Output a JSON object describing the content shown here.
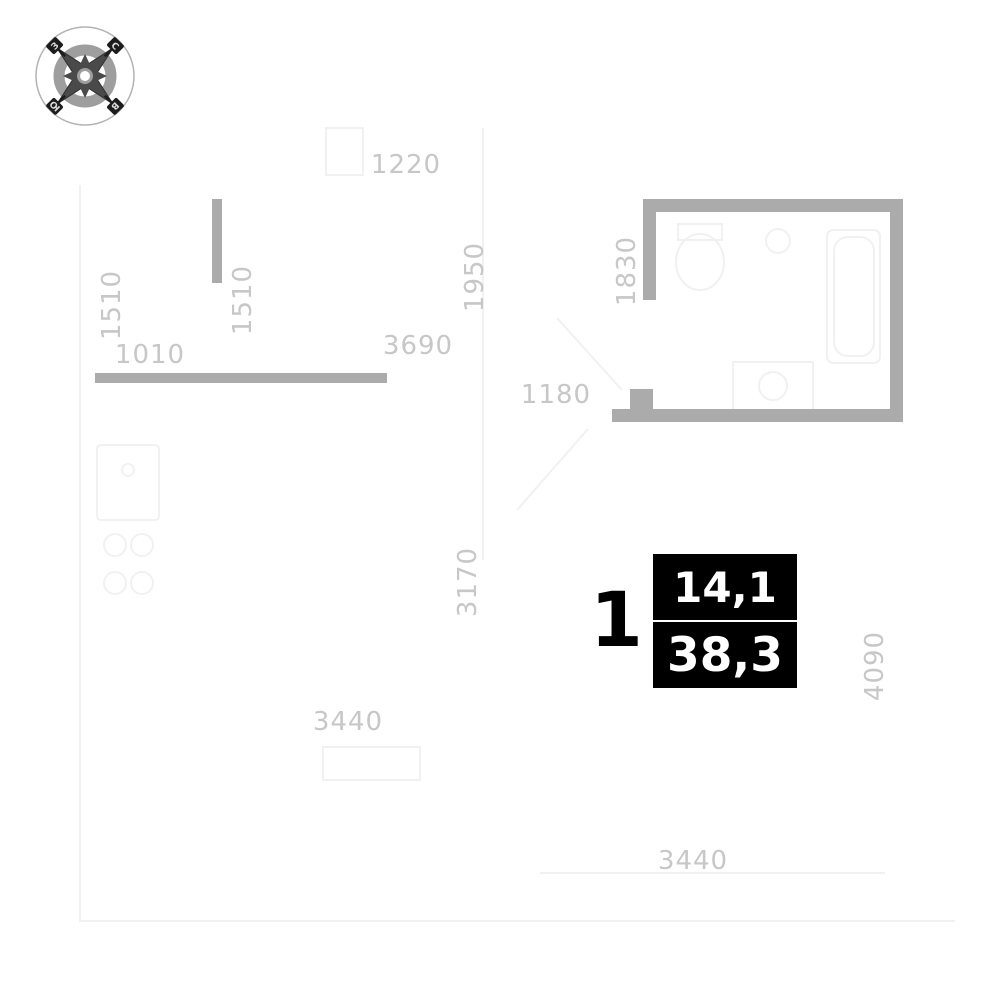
{
  "plan": {
    "unit_number": "1",
    "living_area": "14,1",
    "total_area": "38,3"
  },
  "compass": {
    "north": "С",
    "south": "Ю",
    "east": "В",
    "west": "З"
  },
  "dimensions": [
    {
      "id": "dim-1220",
      "text": "1220",
      "orientation": "horizontal"
    },
    {
      "id": "dim-1510-left",
      "text": "1510",
      "orientation": "vertical"
    },
    {
      "id": "dim-1510-mid",
      "text": "1510",
      "orientation": "vertical"
    },
    {
      "id": "dim-1010",
      "text": "1010",
      "orientation": "horizontal"
    },
    {
      "id": "dim-3690",
      "text": "3690",
      "orientation": "horizontal"
    },
    {
      "id": "dim-1950",
      "text": "1950",
      "orientation": "vertical"
    },
    {
      "id": "dim-1830",
      "text": "1830",
      "orientation": "vertical"
    },
    {
      "id": "dim-1180",
      "text": "1180",
      "orientation": "horizontal"
    },
    {
      "id": "dim-3170",
      "text": "3170",
      "orientation": "vertical"
    },
    {
      "id": "dim-3440-left",
      "text": "3440",
      "orientation": "horizontal"
    },
    {
      "id": "dim-4090",
      "text": "4090",
      "orientation": "vertical"
    },
    {
      "id": "dim-3440-bottom",
      "text": "3440",
      "orientation": "horizontal"
    }
  ],
  "colors": {
    "wall": "#ababab",
    "dimension_text": "#c7c7c7",
    "faint_line": "#f1f1f1",
    "label_background": "#000000",
    "label_text": "#ffffff"
  }
}
